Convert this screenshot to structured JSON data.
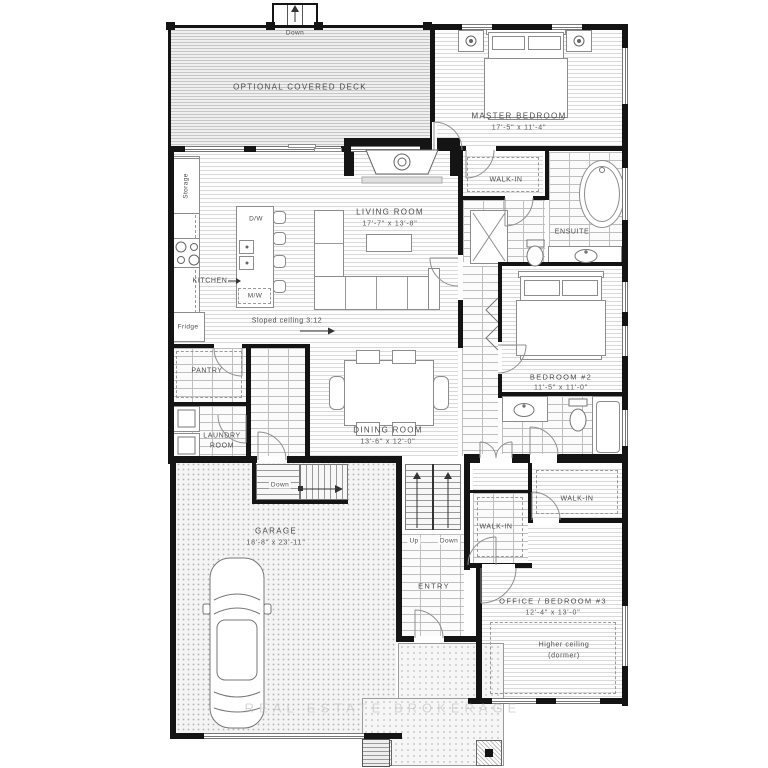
{
  "plan": {
    "type": "residential-floorplan",
    "palette": {
      "wall": "#141414",
      "floor_line": "#d9d9d9",
      "tile_line": "#bfbfbf",
      "text": "#4c4c4c"
    },
    "rooms": {
      "deck": {
        "name": "OPTIONAL COVERED DECK"
      },
      "master": {
        "name": "MASTER BEDROOM",
        "dims": "17'-5\" x 11'-4\""
      },
      "walkin_master": {
        "name": "WALK-IN"
      },
      "ensuite": {
        "name": "ENSUITE"
      },
      "living": {
        "name": "LIVING ROOM",
        "dims": "17'-7\" x 13'-8\""
      },
      "kitchen": {
        "name": "KITCHEN"
      },
      "dining": {
        "name": "DINING ROOM",
        "dims": "13'-6\" x 12'-0\""
      },
      "bedroom2": {
        "name": "BEDROOM #2",
        "dims": "11'-5\" x 11'-0\""
      },
      "pantry": {
        "name": "PANTRY"
      },
      "laundry": {
        "line1": "LAUNDRY",
        "line2": "ROOM"
      },
      "garage": {
        "name": "GARAGE",
        "dims": "18'-8\" x 23'-11\""
      },
      "entry": {
        "name": "ENTRY"
      },
      "office": {
        "name": "OFFICE / BEDROOM #3",
        "dims": "12'-4\" x 13'-0\""
      },
      "walkin_entry": {
        "name": "WALK-IN"
      },
      "walkin_office": {
        "name": "WALK-IN"
      }
    },
    "annotations": {
      "deck_steps": "Down",
      "storage": "Storage",
      "fridge": "Fridge",
      "dw": "D/W",
      "mw": "M/W",
      "sloped_ceiling": "Sloped ceiling 3:12",
      "garage_down": "Down",
      "stairs_up": "Up",
      "stairs_down": "Down",
      "higher_ceiling": "Higher ceiling",
      "dormer": "(dormer)"
    },
    "watermark": "REAL ESTATE BROKERAGE"
  }
}
